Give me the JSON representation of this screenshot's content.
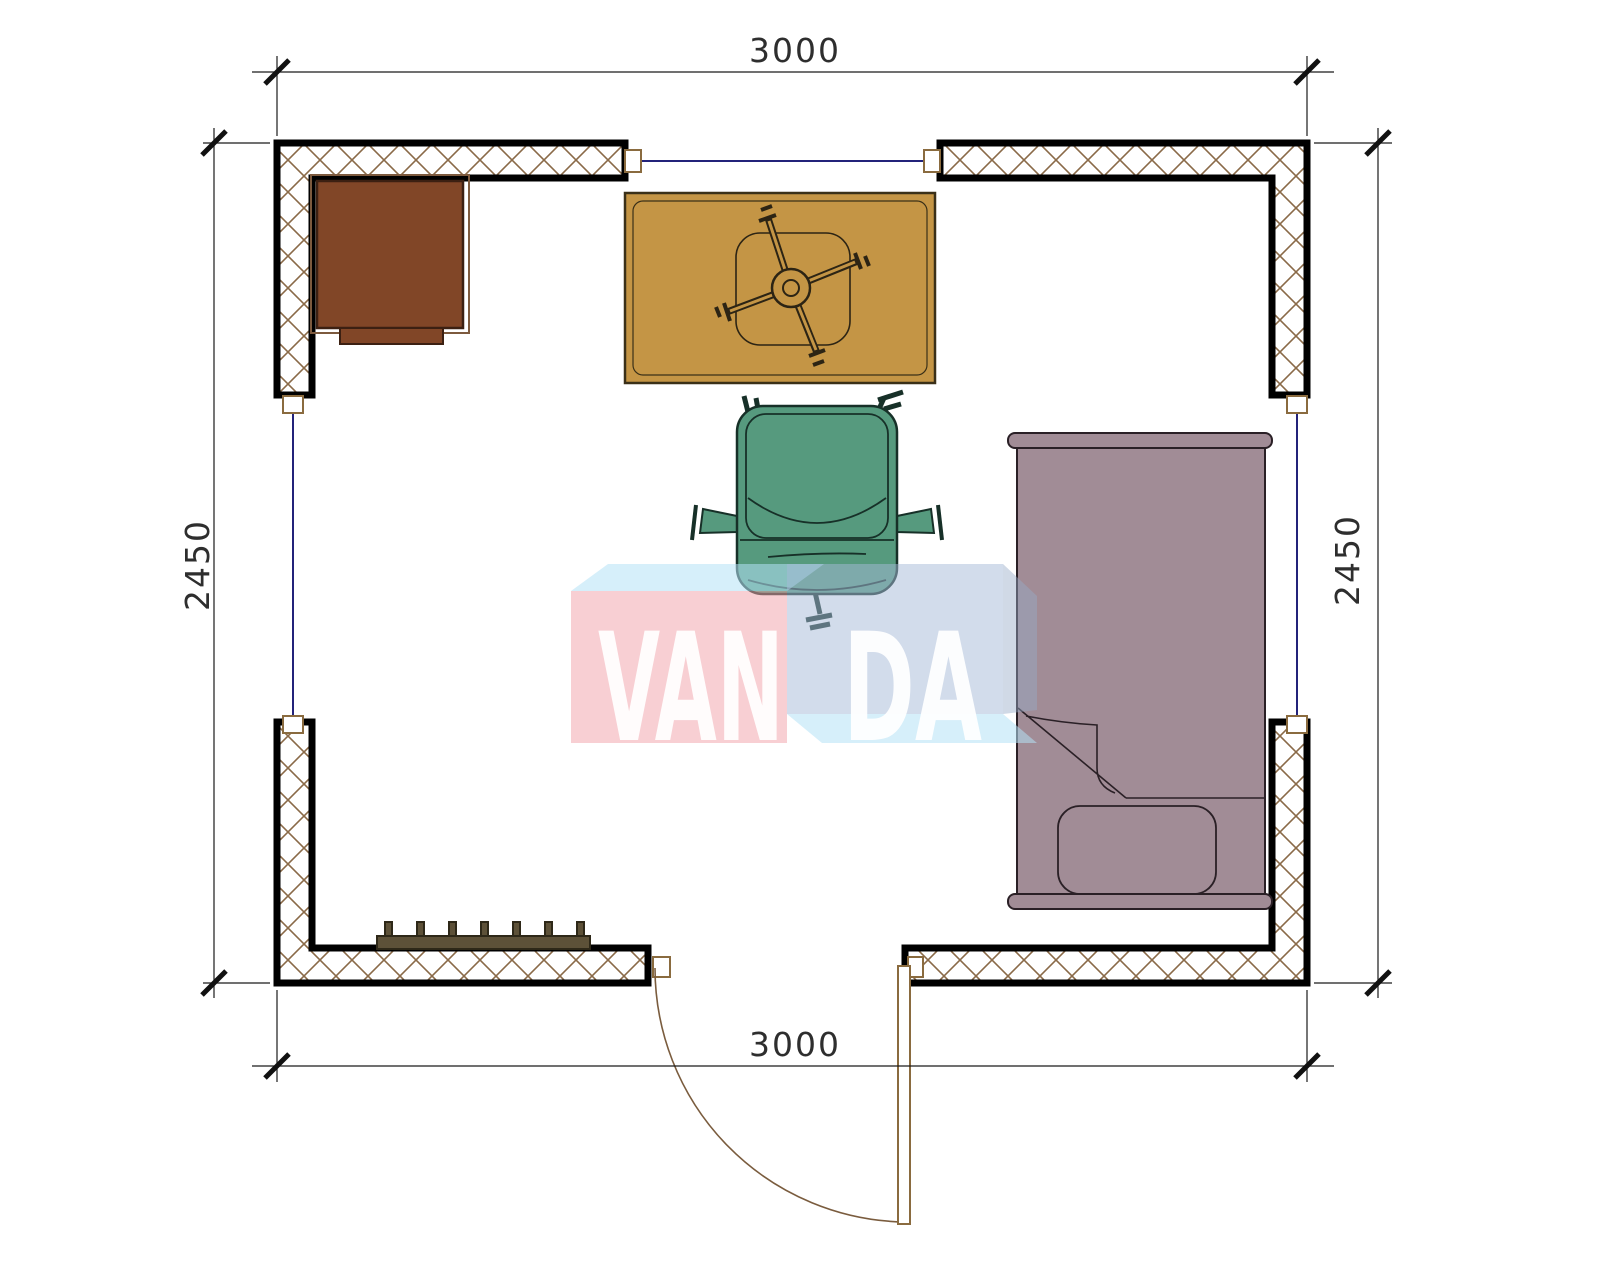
{
  "plan": {
    "title": "Room floor plan",
    "dimensions": {
      "top": "3000",
      "bottom": "3000",
      "left": "2450",
      "right": "2450"
    },
    "watermark": {
      "full": "VANDA",
      "part1": "VAN",
      "part2": "DA"
    },
    "furniture": [
      {
        "name": "cabinet",
        "color": "#814627"
      },
      {
        "name": "desk-with-chair-base",
        "color": "#c49545"
      },
      {
        "name": "office-chair",
        "color": "#569a7e"
      },
      {
        "name": "single-bed",
        "color": "#a18c96"
      },
      {
        "name": "radiator",
        "color": "#5d5138"
      },
      {
        "name": "door",
        "swing": "outward"
      },
      {
        "name": "window-top"
      },
      {
        "name": "window-left"
      },
      {
        "name": "window-right"
      }
    ],
    "colors": {
      "wall_line": "#000000",
      "hatch": "#8a6a48",
      "glazing": "#23237a",
      "jamb": "#8a6b3f",
      "door_arc": "#7a5c3e",
      "dim_line": "#1a1a1a",
      "desk_fill": "#814627",
      "desk_frame": "#7d5a3e",
      "desk_stroke": "#3c2012",
      "table_fill": "#c49545",
      "table_stroke": "#3a3018",
      "chair_fill": "#569a7e",
      "chair_stroke": "#173028",
      "bed_fill": "#a18c96",
      "bed_stroke": "#2a2026",
      "radiator_fill": "#5d5138",
      "radiator_stroke": "#2e2818",
      "wm_pink": "rgba(242,160,167,0.50)",
      "wm_blue": "rgba(165,185,215,0.50)",
      "wm_cyan": "rgba(180,225,245,0.55)",
      "wm_side": "rgba(150,170,200,0.45)"
    }
  }
}
